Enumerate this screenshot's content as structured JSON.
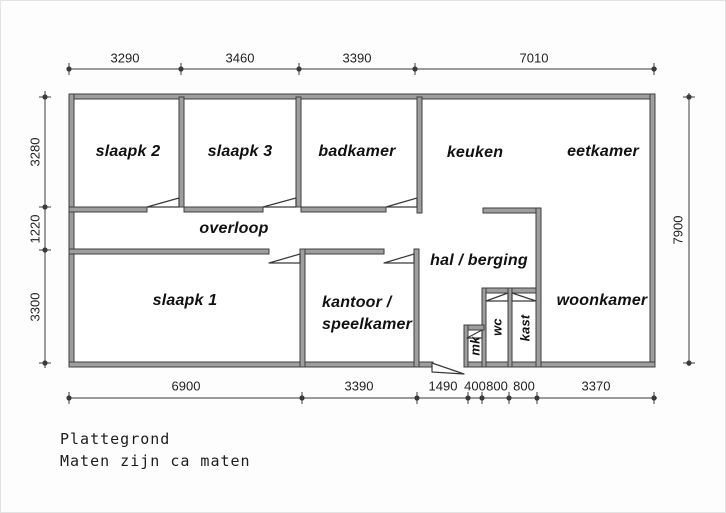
{
  "caption": {
    "line1": "Plattegrond",
    "line2": "Maten zijn ca maten"
  },
  "rooms": {
    "slaapk2": "slaapk 2",
    "slaapk3": "slaapk 3",
    "badkamer": "badkamer",
    "keuken": "keuken",
    "eetkamer": "eetkamer",
    "overloop": "overloop",
    "slaapk1": "slaapk 1",
    "kantoor_line1": "kantoor /",
    "kantoor_line2": "speelkamer",
    "hal": "hal / berging",
    "woonkamer": "woonkamer",
    "mk": "mk",
    "wc": "wc",
    "kast": "kast"
  },
  "dimensions": {
    "top": {
      "seg1": "3290",
      "seg2": "3460",
      "seg3": "3390",
      "seg4": "7010"
    },
    "bottom": {
      "seg1": "6900",
      "seg2": "3390",
      "seg3": "1490",
      "seg4": "400",
      "seg5": "800",
      "seg6": "800",
      "seg7": "3370"
    },
    "left": {
      "seg1": "3280",
      "seg2": "1220",
      "seg3": "3300"
    },
    "right": {
      "seg1": "7900"
    }
  },
  "colors": {
    "wall_fill": "#9e9e9e",
    "wall_edge": "#3f3f3f",
    "line_color": "#3a3a3a",
    "text_color": "#111111",
    "background": "#fdfdfd"
  }
}
